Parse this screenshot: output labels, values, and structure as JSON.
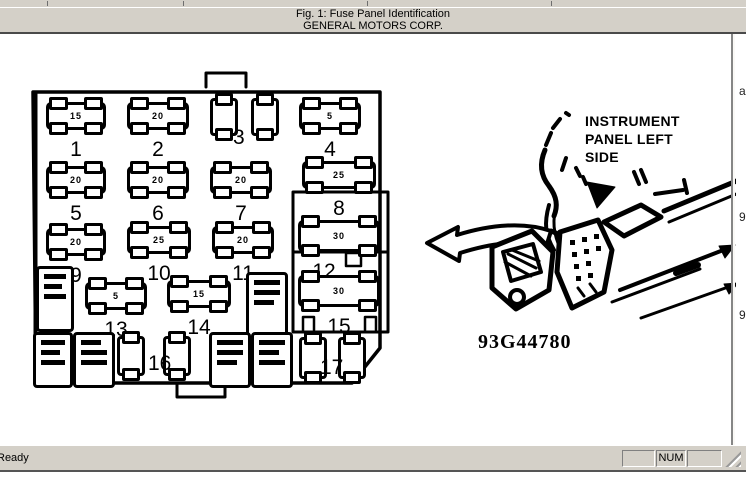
{
  "header": {
    "line1": "Fig. 1: Fuse Panel Identification",
    "line2": "GENERAL MOTORS CORP."
  },
  "status": {
    "ready": "Ready",
    "num": "NUM"
  },
  "edge": {
    "f1": "a",
    "f2": "9",
    "f3": "9"
  },
  "figure": {
    "part_number": "93G44780",
    "callout1": "INSTRUMENT",
    "callout2": "PANEL LEFT",
    "callout3": "SIDE",
    "fuses": {
      "f1": {
        "num": "1",
        "amp": "15"
      },
      "f2": {
        "num": "2",
        "amp": "20"
      },
      "f3": {
        "num": "3",
        "amp": ""
      },
      "f4": {
        "num": "4",
        "amp": "5"
      },
      "f5": {
        "num": "5",
        "amp": "20"
      },
      "f6": {
        "num": "6",
        "amp": "20"
      },
      "f7": {
        "num": "7",
        "amp": "20"
      },
      "f8": {
        "num": "8",
        "amp": "25"
      },
      "f9": {
        "num": "9",
        "amp": "20"
      },
      "f10": {
        "num": "10",
        "amp": "25"
      },
      "f11": {
        "num": "11",
        "amp": "20"
      },
      "f12": {
        "num": "12",
        "amp": "30"
      },
      "f13": {
        "num": "13",
        "amp": "5"
      },
      "f14": {
        "num": "14",
        "amp": "15"
      },
      "f15": {
        "num": "15",
        "amp": "30"
      },
      "f16": {
        "num": "16"
      },
      "f17": {
        "num": "17"
      }
    }
  },
  "colors": {
    "chrome": "#d4d0c8",
    "ink": "#000000",
    "paper": "#ffffff",
    "border_dark": "#4a4a4a",
    "border_mid": "#808080"
  }
}
